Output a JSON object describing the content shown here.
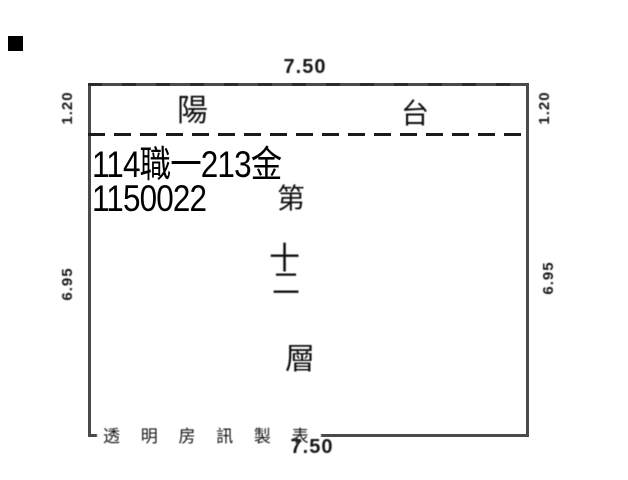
{
  "document": {
    "type_label": "floor-plan scan",
    "colors": {
      "background": "#ffffff",
      "outline": "#4a4a4a",
      "dash_line": "#1b1b1b",
      "ink": "#111111",
      "stamp_ink": "#000000",
      "corner_mark": "#000000"
    }
  },
  "plan": {
    "dimensions": {
      "top": "7.50",
      "bottom": "7.50",
      "left_upper": "1.20",
      "right_upper": "1.20",
      "left_lower": "6.95",
      "right_lower": "6.95"
    },
    "balcony": {
      "left_char": "陽",
      "right_char": "台",
      "word": "陽台"
    },
    "floor": {
      "full": "第十二層",
      "chars": [
        "第",
        "十",
        "二",
        "層"
      ]
    },
    "stamp": {
      "line1": "114職一213金",
      "line2": "1150022"
    },
    "footer": {
      "credit": "透 明 房 訊 製 表"
    }
  }
}
